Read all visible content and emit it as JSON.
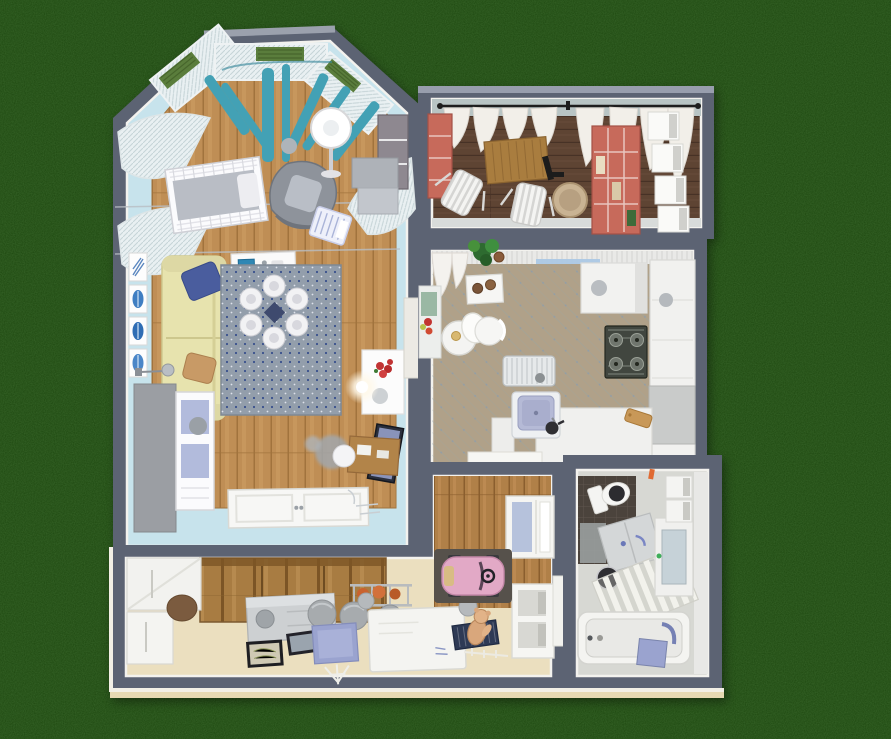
{
  "view": {
    "type": "3d-floorplan-top-down-render",
    "background": "lawn-grass",
    "visible_text": ""
  },
  "palette": {
    "grass": "#1d470f",
    "wall": "#5c6373",
    "wallLight": "#989ead",
    "ledge": "#f2efe5",
    "beigeTrim": "#e6d9b2",
    "livingWall": "#c7e3ec",
    "wood": "#bf8e55",
    "rug": "#939eab",
    "rugDot": "#38508c",
    "sofa": "#e7e3ae",
    "teal": "#43a1b5",
    "sheer": "#e9f0f2",
    "balconyFloor": "#5e4433",
    "balconyWall": "#b8c4c4",
    "coral": "#c76a5b",
    "kitchenFloor": "#b0a189",
    "cabinet": "#f1f1ef",
    "stove": "#41463f",
    "sink": "#b5bad6",
    "bathFloor": "#d7d8d3",
    "bathDark": "#4b433c",
    "hallFloor": "#ebdfbf",
    "wardrobe": "#a87c42",
    "dresser": "#cdd0d2",
    "matNavy": "#2e3a55",
    "matBlue": "#9aa3cf",
    "carPink": "#e2a9c6",
    "carMat": "#56514b",
    "teddy": "#d9a77c"
  },
  "rooms": [
    {
      "id": "living-room",
      "name": "Living room with nursery and bay window",
      "floor": "hardwood with light-blue painted border",
      "furniture": [
        "bay window with teal curtains and sheer panels",
        "window plant boxes",
        "white sheer curtains",
        "baby crib",
        "gray armchair",
        "white floor lamp",
        "bassinet",
        "wall shelving unit",
        "cream sofa with blue and tan pillows",
        "four framed blue artworks",
        "white desk with blue monitor",
        "dotted gray rug",
        "round table with six white stools",
        "white display cabinet with lavender glass",
        "tall gray cabinet",
        "small reading lamp",
        "TV panel",
        "wooden writing desk with chair",
        "fluffy floor pouf",
        "side table with red flowers",
        "glowing floor light",
        "white double door"
      ]
    },
    {
      "id": "balcony",
      "name": "Balcony loggia",
      "floor": "dark wood planks",
      "furniture": [
        "black curtain rod with white curtains",
        "coral cabinet",
        "wooden slat bench",
        "two white folding chairs",
        "round wicker basket",
        "wall-mounted black bracket",
        "coral shelving unit",
        "four white storage cubes"
      ]
    },
    {
      "id": "kitchen",
      "name": "Kitchen",
      "floor": "beige diagonal tile",
      "furniture": [
        "cornice with white curtain",
        "potted green plant",
        "serving table with pots",
        "round white dining table with lamp",
        "white dining chair",
        "side counter with fruit and cutting board",
        "white radiator",
        "tall white cabinet",
        "gas cooktop with four burners",
        "L-shaped white counters",
        "lavender sink with faucet and kettle",
        "wooden cutting board",
        "open door leaf"
      ]
    },
    {
      "id": "bathroom",
      "name": "Bathroom",
      "floor": "light tile with dark shower corner",
      "furniture": [
        "toilet with dark seat",
        "gray bath mat",
        "storage cabinet",
        "dark round stool",
        "slatted towel ladder",
        "vanity with mirror",
        "two wall shelf boxes",
        "bathtub",
        "blue mat with towel hook"
      ]
    },
    {
      "id": "hallway",
      "name": "Hallway with kids corner",
      "floor": "beige with wooden nook",
      "furniture": [
        "wooden plank wardrobe",
        "white hall closets",
        "brown doormat",
        "gray dresser with round knob",
        "two framed pictures on floor",
        "two kettlebells",
        "sports rack with orange balls",
        "three gray poufs",
        "blue mat with white easel",
        "white activity desk",
        "two gray balls",
        "navy mat with white markers",
        "tan teddy bear",
        "pink toy car on dark mat",
        "white shelving unit",
        "glass-front cabinet"
      ]
    }
  ],
  "counts": {
    "dining_stools": 6,
    "storage_cubes": 4,
    "art_frames": 4,
    "poufs": 3,
    "cooktop_burners": 4
  }
}
